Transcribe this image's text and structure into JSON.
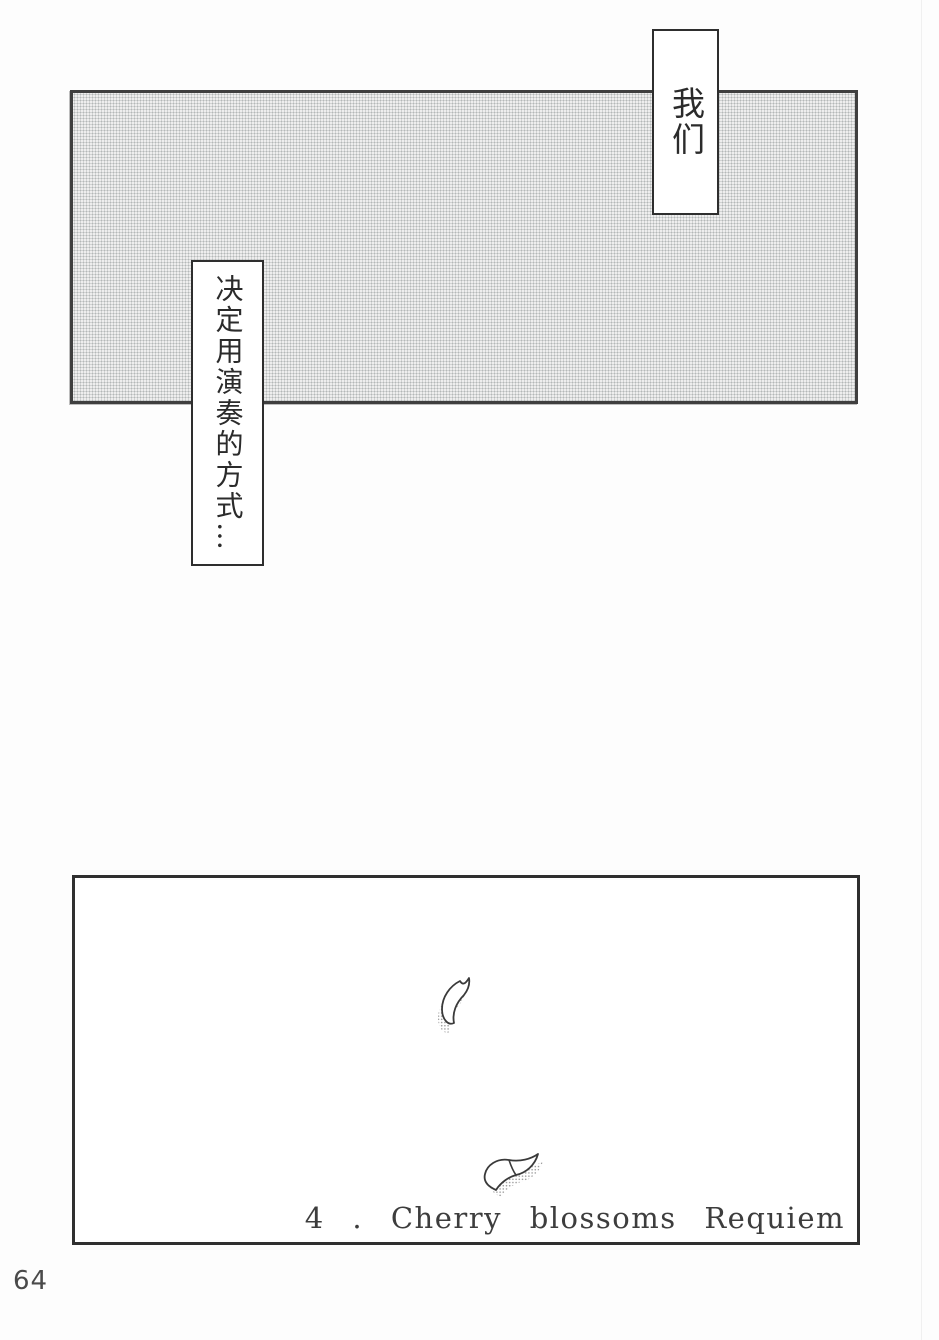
{
  "page": {
    "number": "64"
  },
  "bubbles": {
    "top_right": {
      "text": "我们"
    },
    "left": {
      "text": "决定用演奏的方式…"
    }
  },
  "bottom_panel": {
    "caption": "4 . Cherry blossoms Requiem"
  },
  "icons": {
    "petal_small": "cherry-petal-icon",
    "petal_large": "cherry-petal-icon"
  },
  "colors": {
    "screentone_dot": "#b4b8b8",
    "panel_border": "#3f3f3f",
    "bubble_border": "#2e2e2e",
    "caption_text": "#3d3d3d",
    "page_number_text": "#4a4a4a"
  }
}
